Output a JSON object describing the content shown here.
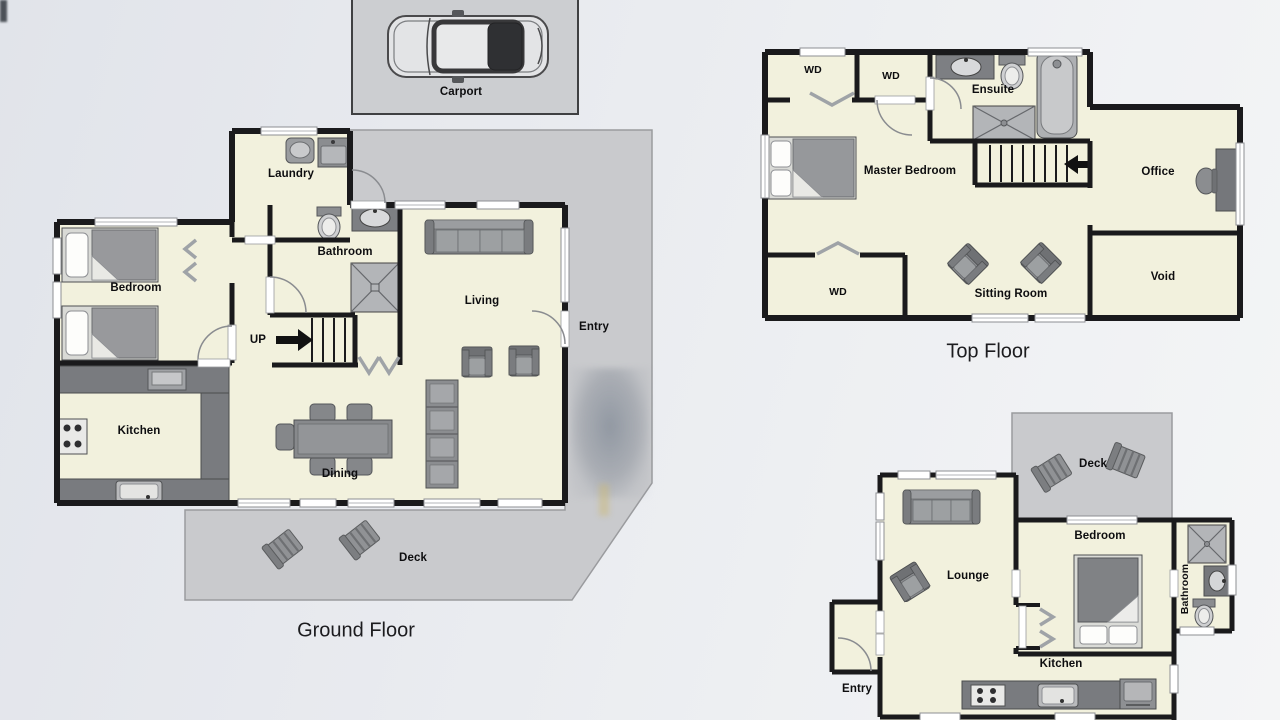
{
  "colors": {
    "paper": "#e8eaee",
    "room_fill": "#f2f1dd",
    "outdoor_gray": "#c9cacd",
    "wall": "#1a1a1c",
    "furniture": "#8f9194",
    "counter": "#7d7f83"
  },
  "carport": {
    "label": "Carport"
  },
  "ground_floor": {
    "title": "Ground Floor",
    "rooms": {
      "laundry": "Laundry",
      "bathroom": "Bathroom",
      "bedroom": "Bedroom",
      "stairs": "UP",
      "living": "Living",
      "entry": "Entry",
      "kitchen": "Kitchen",
      "dining": "Dining",
      "deck": "Deck"
    }
  },
  "top_floor": {
    "title": "Top Floor",
    "rooms": {
      "wd_top_left": "WD",
      "wd_top_mid": "WD",
      "ensuite": "Ensuite",
      "master_bedroom": "Master Bedroom",
      "office": "Office",
      "wd_bottom": "WD",
      "sitting_room": "Sitting Room",
      "void": "Void"
    }
  },
  "lower_floor": {
    "rooms": {
      "deck": "Deck",
      "lounge": "Lounge",
      "bedroom": "Bedroom",
      "bathroom": "Bathroom",
      "kitchen": "Kitchen",
      "entry": "Entry"
    }
  }
}
